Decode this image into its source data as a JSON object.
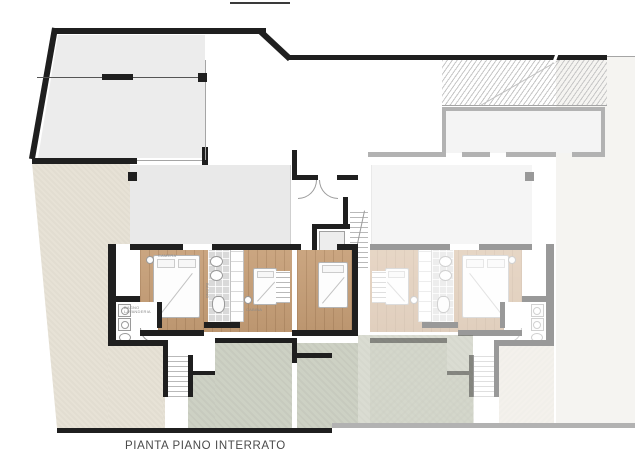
{
  "title": {
    "caption": "PIANTA PIANO INTERRATO"
  },
  "rooms": {
    "camera": "CAMERA",
    "bagno": "BAGNO",
    "cabina": "CABINA",
    "lavanderia": "BAGNO LAVANDERIA"
  },
  "colors": {
    "wall_black": "#1f1f1f",
    "wall_faded": "#b2b2b2",
    "wood_floor": "#c69e76",
    "terrain_beige": "#e7e2d6",
    "patio_green": "#cdd1c4",
    "driveway_gray": "#ececec",
    "caption_text": "#4a4a4a"
  }
}
